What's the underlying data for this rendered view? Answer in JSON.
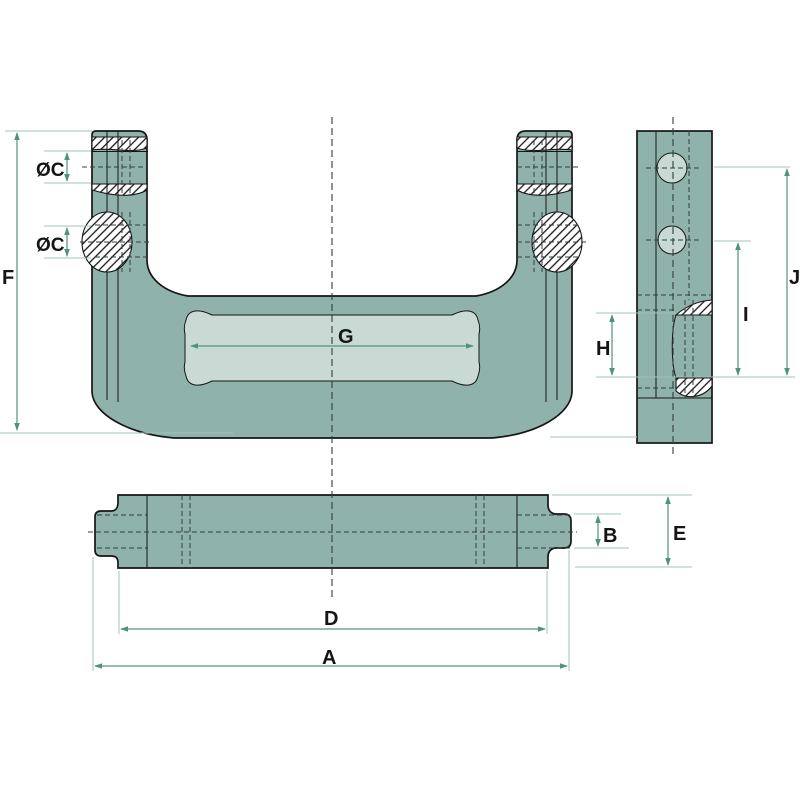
{
  "drawing": {
    "kind": "technical dimension drawing",
    "labels": {
      "A": "A",
      "B": "B",
      "C1": "ØC",
      "C2": "ØC",
      "D": "D",
      "E": "E",
      "F": "F",
      "G": "G",
      "H": "H",
      "I": "I",
      "J": "J"
    },
    "colors": {
      "background": "#ffffff",
      "body": "#8fb2ab",
      "recess": "#c9d9d3",
      "outline": "#161616",
      "dimension": "#4f937f",
      "extension": "#a3c3ba",
      "centerline": "#333d3c",
      "hatch_line": "#161616"
    }
  }
}
